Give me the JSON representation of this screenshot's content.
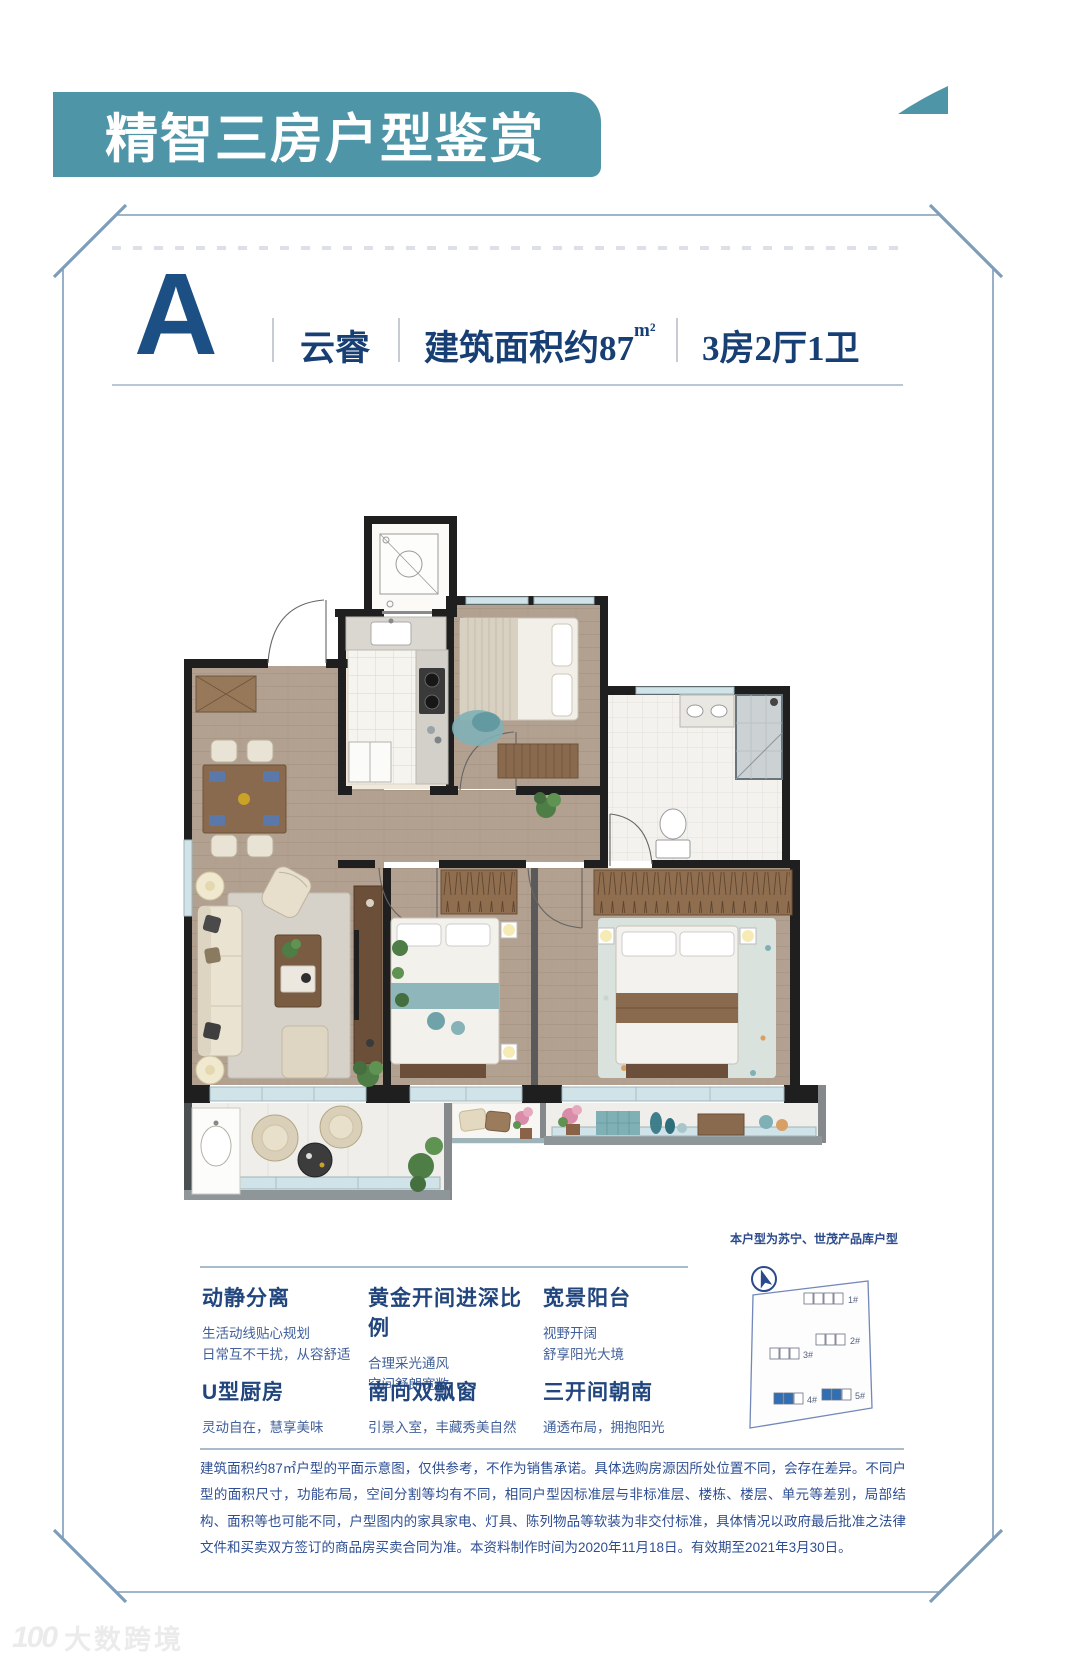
{
  "header": {
    "title": "精智三房户型鉴赏"
  },
  "unit": {
    "letter": "A",
    "name": "云睿",
    "area_label": "建筑面积约87",
    "area_unit": "m²",
    "rooms": "3房2厅1卫"
  },
  "product_note": "本户型为苏宁、世茂产品库户型",
  "features": [
    {
      "title": "动静分离",
      "lines": [
        "生活动线贴心规划",
        "日常互不干扰，从容舒适"
      ]
    },
    {
      "title": "黄金开间进深比例",
      "lines": [
        "合理采光通风",
        "空间舒朗宽敞"
      ]
    },
    {
      "title": "宽景阳台",
      "lines": [
        "视野开阔",
        "舒享阳光大境"
      ]
    },
    {
      "title": "U型厨房",
      "lines": [
        "灵动自在，慧享美味"
      ]
    },
    {
      "title": "南向双飘窗",
      "lines": [
        "引景入室，丰藏秀美自然"
      ]
    },
    {
      "title": "三开间朝南",
      "lines": [
        "通透布局，拥抱阳光"
      ]
    }
  ],
  "siteplan": {
    "buildings": [
      "1#",
      "2#",
      "3#",
      "4#",
      "5#"
    ]
  },
  "disclaimer": "建筑面积约87㎡户型的平面示意图，仅供参考，不作为销售承诺。具体选购房源因所处位置不同，会存在差异。不同户型的面积尺寸，功能布局，空间分割等均有不同，相同户型因标准层与非标准层、楼栋、楼层、单元等差别，局部结构、面积等也可能不同，户型图内的家具家电、灯具、陈列物品等软装为非交付标准，具体情况以政府最后批准之法律文件和买卖双方签订的商品房买卖合同为准。本资料制作时间为2020年11月18日。有效期至2021年3月30日。",
  "watermark": {
    "logo": "100",
    "brand": "大数跨境"
  },
  "colors": {
    "banner_teal": "#4e95a8",
    "title_navy": "#1c4f83",
    "text_navy": "#2e4e93",
    "highlight_blue": "#2e6fb5",
    "frame_blue": "#7e9dba"
  }
}
